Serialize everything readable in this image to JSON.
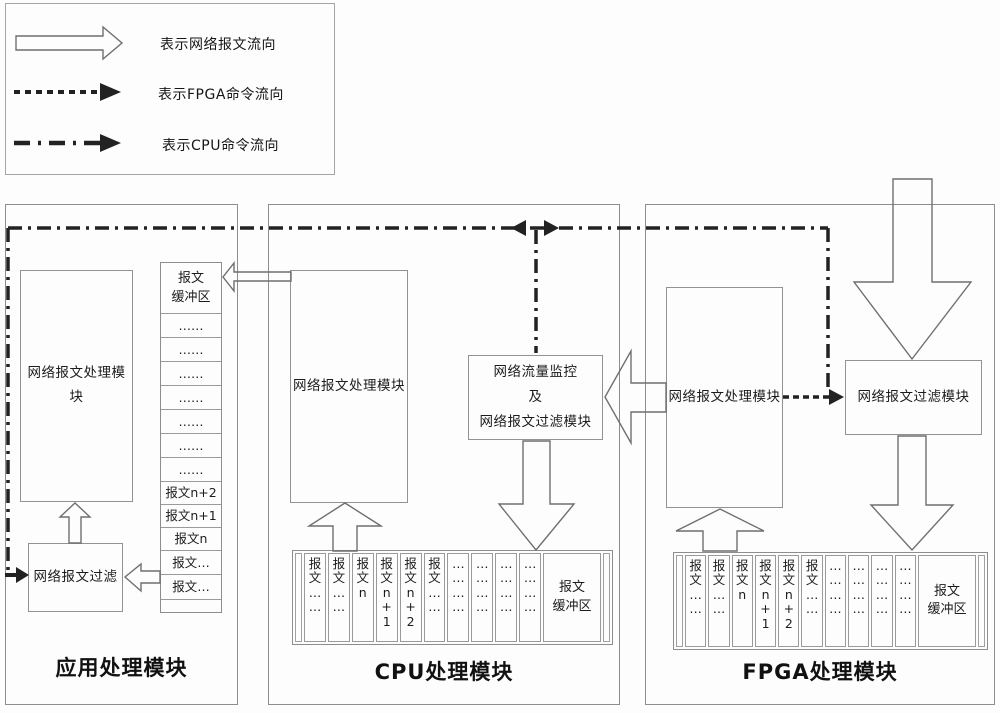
{
  "legend": {
    "items": [
      {
        "style": "hollow-arrow",
        "label": "表示网络报文流向"
      },
      {
        "style": "dashed-arrow",
        "label": "表示FPGA命令流向"
      },
      {
        "style": "dashdot-arrow",
        "label": "表示CPU命令流向"
      }
    ]
  },
  "app_module": {
    "title": "应用处理模块",
    "processor_label": "网络报文处理模块",
    "filter_label": "网络报文过滤",
    "buffer": {
      "header": "报文\n缓冲区",
      "cells": [
        "……",
        "……",
        "……",
        "……",
        "……",
        "……",
        "……",
        "报文n+2",
        "报文n+1",
        "报文n",
        "报文…",
        "报文…",
        ""
      ]
    }
  },
  "cpu_module": {
    "title": "CPU处理模块",
    "processor_label": "网络报文处理模块",
    "monitor_label": "网络流量监控\n及\n网络报文过滤模块",
    "buffer": {
      "label": "报文\n缓冲区",
      "cells": [
        "报\n文\n…\n…",
        "报\n文\n…\n…",
        "报\n文\nn",
        "报\n文\nn\n+\n1",
        "报\n文\nn\n+\n2",
        "报\n文\n…\n…",
        "…\n…\n…\n…",
        "…\n…\n…\n…",
        "…\n…\n…\n…",
        "…\n…\n…\n…"
      ]
    }
  },
  "fpga_module": {
    "title": "FPGA处理模块",
    "processor_label": "网络报文处理模块",
    "filter_label": "网络报文过滤模块",
    "buffer": {
      "label": "报文\n缓冲区",
      "cells": [
        "报\n文\n…\n…",
        "报\n文\n…\n…",
        "报\n文\nn",
        "报\n文\nn\n+\n1",
        "报\n文\nn\n+\n2",
        "报\n文\n…\n…",
        "…\n…\n…\n…",
        "…\n…\n…\n…",
        "…\n…\n…\n…",
        "…\n…\n…\n…"
      ]
    }
  },
  "colors": {
    "command_line": "#222222",
    "box_border": "#8d8d8d",
    "hollow_arrow_stroke": "#6f6f6f",
    "background": "#fdfdfd"
  }
}
